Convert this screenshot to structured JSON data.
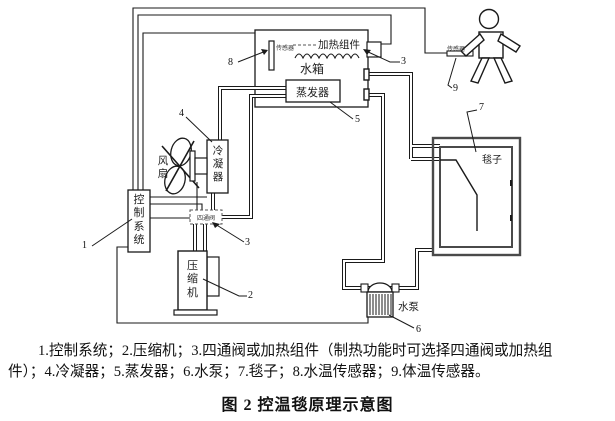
{
  "diagram": {
    "components": {
      "control_system": "控制系统",
      "fan": "风扇",
      "condenser": "冷凝器",
      "compressor": "压缩机",
      "water_tank": "水箱",
      "heating_module": "加热组件",
      "evaporator": "蒸发器",
      "four_way_valve": "四通阀",
      "blanket": "毯子",
      "water_pump": "水泵",
      "water_temp_sensor": "传感器",
      "body_temp_sensor": "传感器"
    },
    "callouts": {
      "n1": "1",
      "n2": "2",
      "n3_valve": "3",
      "n3_heater": "3",
      "n4": "4",
      "n5": "5",
      "n6": "6",
      "n7": "7",
      "n8": "8",
      "n9": "9"
    },
    "colors": {
      "line": "#1a1a1a",
      "blanket_wall": "#4a4a4a"
    }
  },
  "caption": {
    "line1": "1.控制系统；2.压缩机；3.四通阀或加热组件（制热功能时可选择四通阀或加热组",
    "line2": "件）；4.冷凝器；5.蒸发器；6.水泵；7.毯子；8.水温传感器；9.体温传感器。"
  },
  "title": "图 2 控温毯原理示意图"
}
